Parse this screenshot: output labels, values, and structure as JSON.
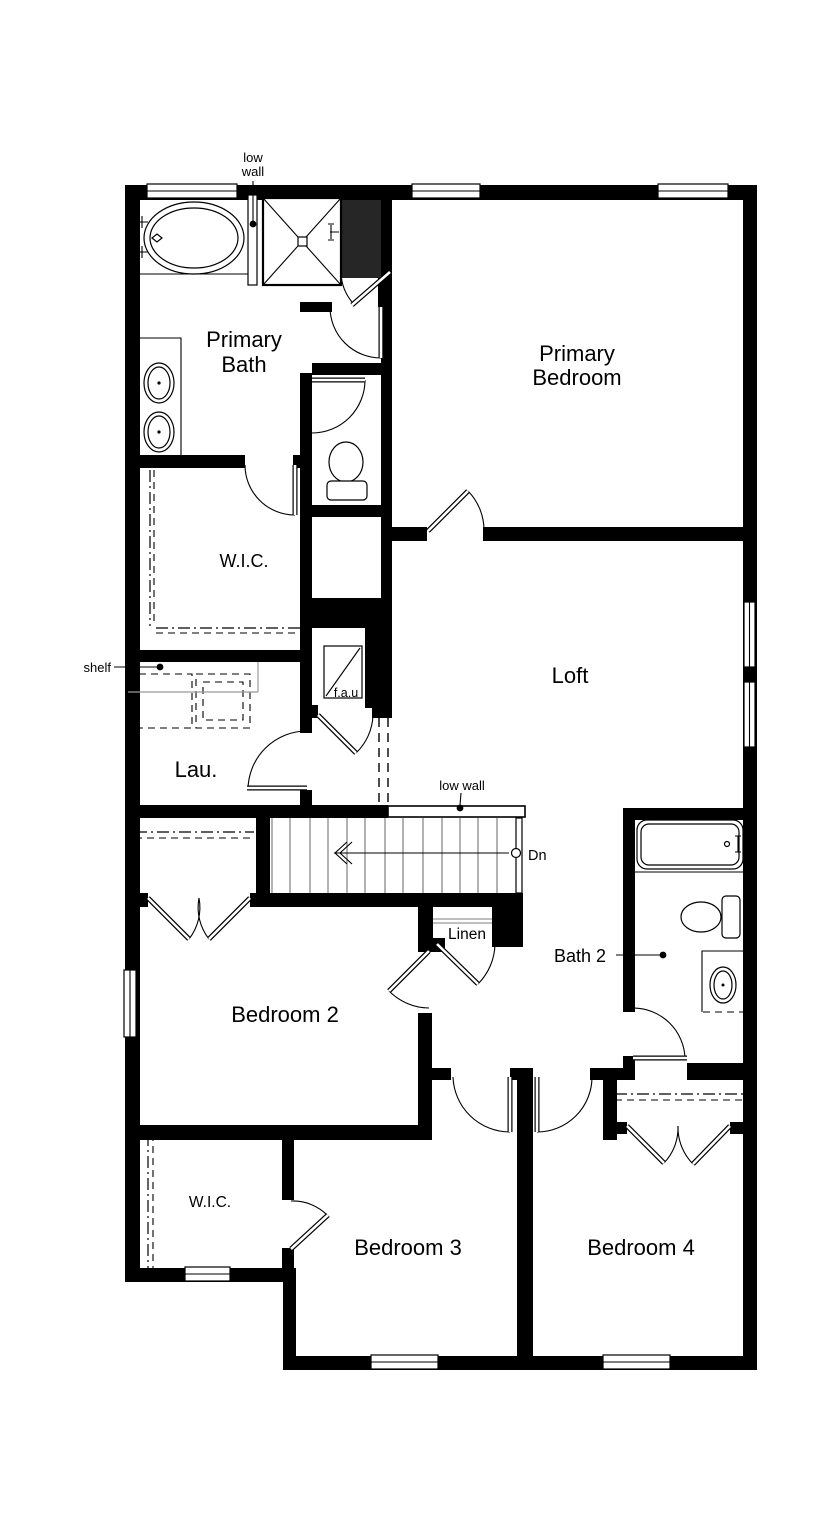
{
  "document": {
    "type": "floor-plan",
    "floor": "second"
  },
  "colors": {
    "background": "#ffffff",
    "wall": "#000000",
    "chase_fill": "#262626",
    "tread_line": "#666666",
    "shelf_line": "#999999",
    "text": "#000000"
  },
  "rooms": {
    "primary_bath": {
      "name_line1": "Primary",
      "name_line2": "Bath"
    },
    "primary_bedroom": {
      "name_line1": "Primary",
      "name_line2": "Bedroom"
    },
    "primary_wic": {
      "name": "W.I.C."
    },
    "loft": {
      "name": "Loft"
    },
    "laundry": {
      "name": "Lau."
    },
    "linen_closet": {
      "name": "Linen"
    },
    "bath_2": {
      "name": "Bath 2"
    },
    "bedroom_2": {
      "name": "Bedroom 2"
    },
    "wic_2": {
      "name": "W.I.C."
    },
    "bedroom_3": {
      "name": "Bedroom 3"
    },
    "bedroom_4": {
      "name": "Bedroom 4"
    }
  },
  "annotations": {
    "tub_low_wall_line1": "low",
    "tub_low_wall_line2": "wall",
    "stair_low_wall": "low wall",
    "shelf": "shelf",
    "fau_unit": "f.a.u",
    "stair_direction": "Dn"
  }
}
